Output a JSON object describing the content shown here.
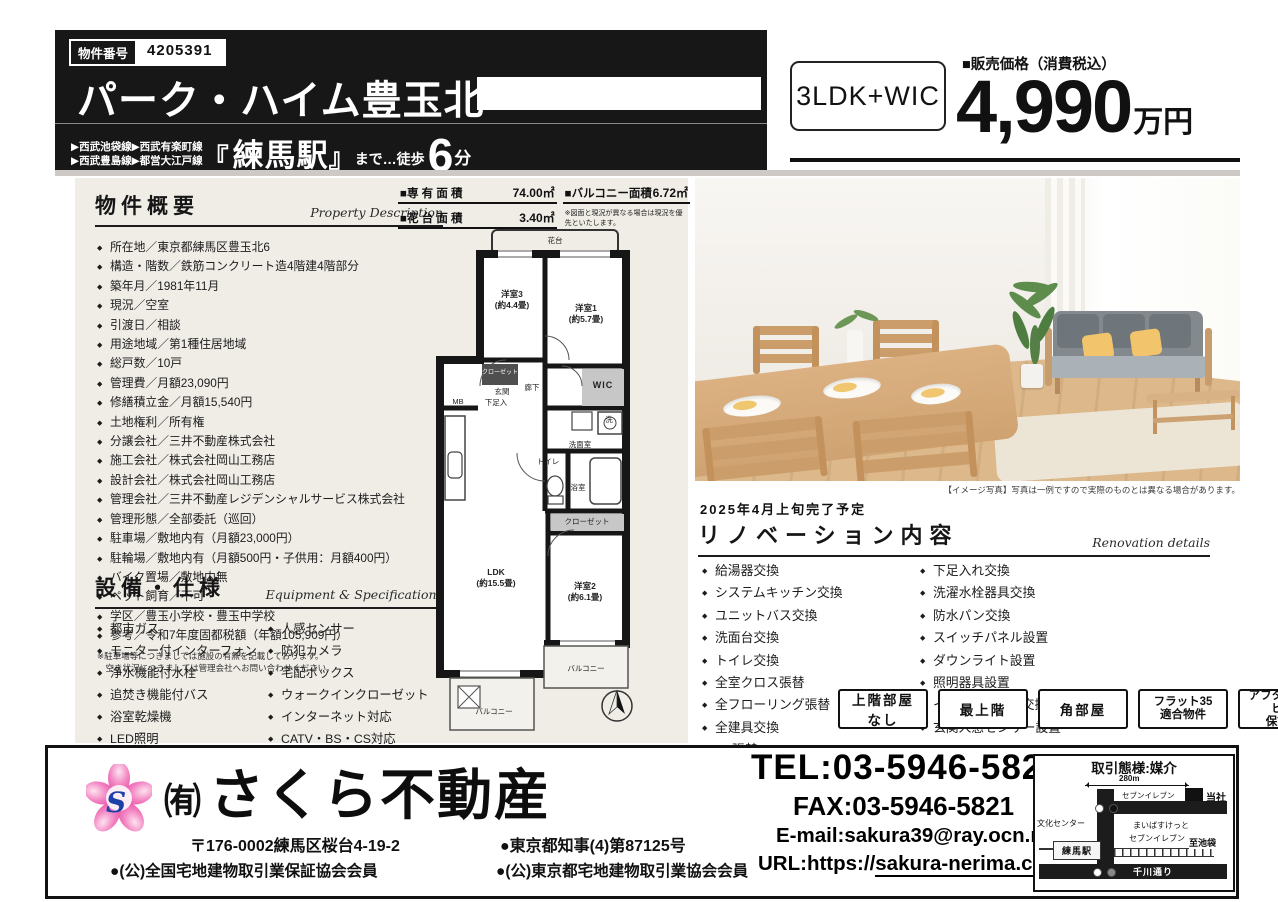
{
  "header": {
    "property_no_label": "物件番号",
    "property_no": "4205391",
    "title": "パーク・ハイム豊玉北",
    "line1": "▶西武池袋線▶西武有楽町線",
    "line2": "▶西武豊島線▶都営大江戸線",
    "bracket_open": "『",
    "station": "練馬駅",
    "bracket_close": "』",
    "walk_text": "まで…徒歩",
    "minutes": "6",
    "minutes_unit": "分",
    "layout": "3LDK+WIC",
    "price_label": "■販売価格（消費税込）",
    "price": "4,990",
    "price_unit": "万円"
  },
  "overview": {
    "heading": "物件概要",
    "heading_en": "Property Description",
    "items": [
      "所在地／東京都練馬区豊玉北6",
      "構造・階数／鉄筋コンクリート造4階建4階部分",
      "築年月／1981年11月",
      "現況／空室",
      "引渡日／相談",
      "用途地域／第1種住居地域",
      "総戸数／10戸",
      "管理費／月額23,090円",
      "修繕積立金／月額15,540円",
      "土地権利／所有権",
      "分譲会社／三井不動産株式会社",
      "施工会社／株式会社岡山工務店",
      "設計会社／株式会社岡山工務店",
      "管理会社／三井不動産レジデンシャルサービス株式会社",
      "管理形態／全部委託（巡回）",
      "駐車場／敷地内有（月額23,000円）",
      "駐輪場／敷地内有（月額500円・子供用：月額400円）",
      "バイク置場／敷地内無",
      "ペット飼育／不可",
      "学区／豊玉小学校・豊玉中学校",
      "参考／令和7年度固都税額（年額105,909円）"
    ],
    "note": "※駐車場等につきましては施設の有無を記載しております。\n　空き状況につきましては管理会社へお問い合わせください。"
  },
  "equipment": {
    "heading": "設備・仕様",
    "heading_en": "Equipment & Specifications",
    "left": [
      "都市ガス",
      "モニター付インターフォン",
      "浄水機能付水栓",
      "追焚き機能付バス",
      "浴室乾燥機",
      "LED照明"
    ],
    "right": [
      "人感センサー",
      "防犯カメラ",
      "宅配ボックス",
      "ウォークインクローゼット",
      "インターネット対応",
      "CATV・BS・CS対応"
    ]
  },
  "plan": {
    "a1l": "■専 有 面 積",
    "a1v": "74.00㎡",
    "a2l": "■バルコニー面積",
    "a2v": "6.72㎡",
    "a3l": "■花 台 面 積",
    "a3v": "3.40㎡",
    "note": "※図面と現況が異なる場合は現況を優先といたします。",
    "labels": [
      {
        "t": "花台",
        "x": 135,
        "y": 15,
        "c": "sm"
      },
      {
        "t": "洋室3\n(約4.4畳)",
        "x": 92,
        "y": 74
      },
      {
        "t": "洋室1\n(約5.7畳)",
        "x": 166,
        "y": 88
      },
      {
        "t": "クローゼット",
        "x": 80,
        "y": 148,
        "c": "wh"
      },
      {
        "t": "玄関",
        "x": 82,
        "y": 166,
        "c": "sm"
      },
      {
        "t": "MB",
        "x": 38,
        "y": 176,
        "c": "sm"
      },
      {
        "t": "下足入",
        "x": 76,
        "y": 177,
        "c": "sm"
      },
      {
        "t": "廊下",
        "x": 112,
        "y": 162,
        "c": "sm"
      },
      {
        "t": "WIC",
        "x": 183,
        "y": 160,
        "c": "sm9"
      },
      {
        "t": "洗",
        "x": 189,
        "y": 194,
        "c": "sm"
      },
      {
        "t": "洗面室",
        "x": 160,
        "y": 219,
        "c": "sm"
      },
      {
        "t": "トイレ",
        "x": 128,
        "y": 236,
        "c": "sm"
      },
      {
        "t": "浴室",
        "x": 158,
        "y": 262,
        "c": "sm"
      },
      {
        "t": "クローゼット",
        "x": 167,
        "y": 296,
        "c": "sm"
      },
      {
        "t": "LDK\n(約15.5畳)",
        "x": 76,
        "y": 352
      },
      {
        "t": "洋室2\n(約6.1畳)",
        "x": 165,
        "y": 366
      },
      {
        "t": "バルコニー",
        "x": 166,
        "y": 443,
        "c": "sm"
      },
      {
        "t": "バルコニー",
        "x": 74,
        "y": 486,
        "c": "sm"
      }
    ]
  },
  "photo": {
    "caption": "【イメージ写真】写真は一例ですので実際のものとは異なる場合があります。"
  },
  "renovation": {
    "date": "2025年4月上旬完了予定",
    "heading": "リノベーション内容",
    "heading_en": "Renovation details",
    "left": [
      "給湯器交換",
      "システムキッチン交換",
      "ユニットバス交換",
      "洗面台交換",
      "トイレ交換",
      "全室クロス張替",
      "全フローリング張替",
      "全建具交換",
      "CF張替"
    ],
    "right": [
      "下足入れ交換",
      "洗濯水栓器具交換",
      "防水パン交換",
      "スイッチパネル設置",
      "ダウンライト設置",
      "照明器具設置",
      "インターフォン交換",
      "玄関人感センサー設置"
    ]
  },
  "badges": [
    "上階部屋なし",
    "最上階",
    "角部屋",
    "フラット35\n適合物件",
    "アフターサービス\n保証付"
  ],
  "footer": {
    "logo_letter": "S",
    "company_prefix": "㈲",
    "company": "さくら不動産",
    "address": "〒176-0002練馬区桜台4-19-2",
    "license": "●東京都知事(4)第87125号",
    "member1": "●(公)全国宅地建物取引業保証協会会員",
    "member2": "●(公)東京都宅地建物取引業協会会員",
    "tel": "TEL:03-5946-5820",
    "fax": "FAX:03-5946-5821",
    "email": "E-mail:sakura39@ray.ocn.ne.jp",
    "url_prefix": "URL:https://",
    "url_domain": "sakura-nerima.com"
  },
  "map": {
    "title": "取引態様:媒介",
    "distance": "280m",
    "seven1": "セブンイレブン",
    "tousha": "当社",
    "bunka": "文化センター",
    "maibasu": "まいばすけっと",
    "seven2": "セブンイレブン",
    "station": "練馬駅",
    "ikebukuro": "至池袋",
    "senkawa": "千川通り"
  }
}
